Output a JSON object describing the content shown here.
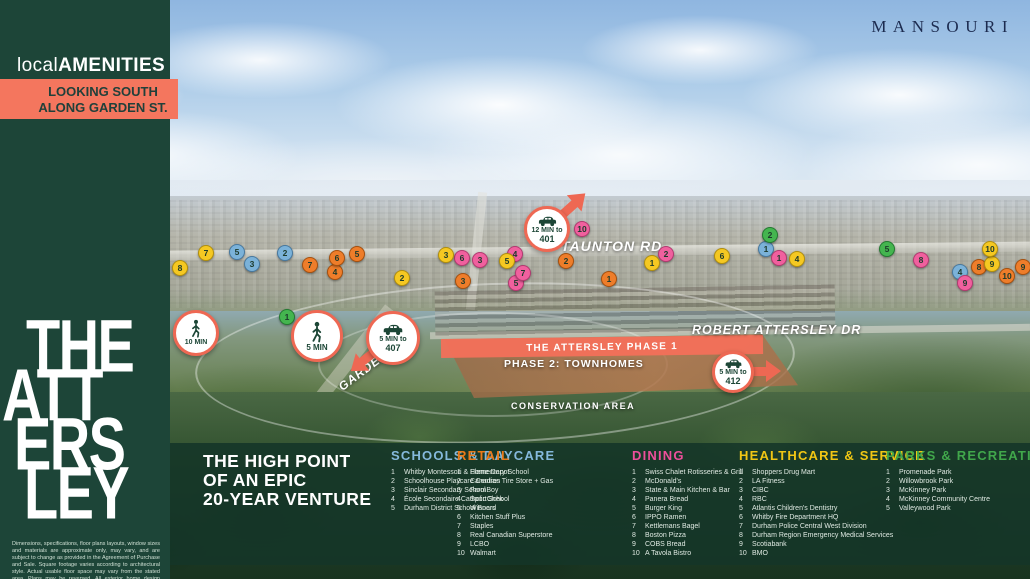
{
  "colors": {
    "sidebar_green": "#1d4538",
    "coral_banner": "#f4765e",
    "badge_coral": "#ee6853",
    "panel_green": "rgba(21,53,40,0.88)",
    "schools": "#85b9dc",
    "retail": "#ea7a19",
    "dining": "#ee4f9b",
    "healthcare": "#f0c614",
    "parks": "#41a74b"
  },
  "header": {
    "developer_logo": "MANSOURI"
  },
  "sidebar": {
    "logo_light": "local",
    "logo_bold": "AMENITIES",
    "view_banner": [
      "LOOKING SOUTH",
      "ALONG GARDEN ST."
    ],
    "project_logo": [
      "THE",
      "ATT",
      "ERS",
      "LEY"
    ],
    "disclaimer": "Dimensions, specifications, floor plans layouts, window sizes and materials are approximate only, may vary, and are subject to change as provided in the Agreement of Purchase and Sale. Square footage varies according to architectural style. Actual usable floor space may vary from the stated area. Plans may be reversed. All exterior home design illustrations are artist's concepts. E.&O.E."
  },
  "map": {
    "road_labels": {
      "taunton": "TAUNTON RD",
      "robert_attersley": "ROBERT ATTERSLEY DR",
      "garden": "GARDEN ST"
    },
    "site_labels": {
      "phase1": "THE ATTERSLEY PHASE 1",
      "phase2": "PHASE 2: TOWNHOMES",
      "conservation": "CONSERVATION AREA"
    },
    "badges": {
      "walk10": {
        "type": "walk",
        "line1": "10 MIN"
      },
      "walk5": {
        "type": "walk",
        "line1": "5 MIN"
      },
      "car407": {
        "type": "car",
        "line1": "5 MIN to",
        "line2": "407"
      },
      "car401": {
        "type": "car",
        "line1": "12 MIN to",
        "line2": "401"
      },
      "car412": {
        "type": "car",
        "line1": "5 MIN to",
        "line2": "412"
      }
    },
    "markers": [
      {
        "category": "schools",
        "label": "1",
        "x": 766,
        "y": 249
      },
      {
        "category": "schools",
        "label": "2",
        "x": 285,
        "y": 253
      },
      {
        "category": "schools",
        "label": "3",
        "x": 252,
        "y": 264
      },
      {
        "category": "schools",
        "label": "4",
        "x": 960,
        "y": 272
      },
      {
        "category": "schools",
        "label": "5",
        "x": 237,
        "y": 252
      },
      {
        "category": "retail",
        "label": "1",
        "x": 609,
        "y": 279
      },
      {
        "category": "retail",
        "label": "2",
        "x": 566,
        "y": 261
      },
      {
        "category": "retail",
        "label": "3",
        "x": 463,
        "y": 281
      },
      {
        "category": "retail",
        "label": "4",
        "x": 335,
        "y": 272
      },
      {
        "category": "retail",
        "label": "5",
        "x": 357,
        "y": 254
      },
      {
        "category": "retail",
        "label": "6",
        "x": 337,
        "y": 258
      },
      {
        "category": "retail",
        "label": "7",
        "x": 310,
        "y": 265
      },
      {
        "category": "retail",
        "label": "8",
        "x": 979,
        "y": 267
      },
      {
        "category": "retail",
        "label": "9",
        "x": 1023,
        "y": 267
      },
      {
        "category": "retail",
        "label": "10",
        "x": 1007,
        "y": 276
      },
      {
        "category": "dining",
        "label": "1",
        "x": 779,
        "y": 258
      },
      {
        "category": "dining",
        "label": "2",
        "x": 666,
        "y": 254
      },
      {
        "category": "dining",
        "label": "3",
        "x": 480,
        "y": 260
      },
      {
        "category": "dining",
        "label": "4",
        "x": 515,
        "y": 254
      },
      {
        "category": "dining",
        "label": "5",
        "x": 516,
        "y": 283
      },
      {
        "category": "dining",
        "label": "6",
        "x": 462,
        "y": 258
      },
      {
        "category": "dining",
        "label": "7",
        "x": 523,
        "y": 273
      },
      {
        "category": "dining",
        "label": "8",
        "x": 921,
        "y": 260
      },
      {
        "category": "dining",
        "label": "9",
        "x": 965,
        "y": 283
      },
      {
        "category": "dining",
        "label": "10",
        "x": 582,
        "y": 229
      },
      {
        "category": "healthcare",
        "label": "1",
        "x": 652,
        "y": 263
      },
      {
        "category": "healthcare",
        "label": "2",
        "x": 402,
        "y": 278
      },
      {
        "category": "healthcare",
        "label": "3",
        "x": 446,
        "y": 255
      },
      {
        "category": "healthcare",
        "label": "4",
        "x": 797,
        "y": 259
      },
      {
        "category": "healthcare",
        "label": "5",
        "x": 507,
        "y": 261
      },
      {
        "category": "healthcare",
        "label": "6",
        "x": 722,
        "y": 256
      },
      {
        "category": "healthcare",
        "label": "7",
        "x": 206,
        "y": 253
      },
      {
        "category": "healthcare",
        "label": "8",
        "x": 180,
        "y": 268
      },
      {
        "category": "healthcare",
        "label": "9",
        "x": 992,
        "y": 264
      },
      {
        "category": "healthcare",
        "label": "10",
        "x": 990,
        "y": 249
      },
      {
        "category": "parks",
        "label": "1",
        "x": 287,
        "y": 317
      },
      {
        "category": "parks",
        "label": "2",
        "x": 770,
        "y": 235
      },
      {
        "category": "parks",
        "label": "5",
        "x": 887,
        "y": 249
      }
    ]
  },
  "legend": {
    "tagline": [
      "THE HIGH POINT",
      "OF AN EPIC",
      "20-YEAR VENTURE"
    ],
    "categories": [
      {
        "id": "schools",
        "label": "SCHOOLS & DAYCARE",
        "color": "#85b9dc",
        "items": [
          "Whitby Montessori & Elementary School",
          "Schoolhouse Playcare Centres",
          "Sinclair Secondary School",
          "École Secondaire Catholic School",
          "Durham District School Board"
        ]
      },
      {
        "id": "retail",
        "label": "RETAIL",
        "color": "#ea7a19",
        "items": [
          "Home Depot",
          "Canadian Tire Store + Gas",
          "FarmBoy",
          "SportChek",
          "Winners",
          "Kitchen Stuff Plus",
          "Staples",
          "Real Canadian Superstore",
          "LCBO",
          "Walmart"
        ]
      },
      {
        "id": "dining",
        "label": "DINING",
        "color": "#ee4f9b",
        "items": [
          "Swiss Chalet Rotisseries & Grill",
          "McDonald's",
          "State & Main Kitchen & Bar",
          "Panera Bread",
          "Burger King",
          "IPPO Ramen",
          "Kettlemans Bagel",
          "Boston Pizza",
          "COBS Bread",
          "A Tavola Bistro"
        ]
      },
      {
        "id": "healthcare",
        "label": "HEALTHCARE & SERVICE",
        "color": "#f0c614",
        "items": [
          "Shoppers Drug Mart",
          "LA Fitness",
          "CIBC",
          "RBC",
          "Atlantis Children's Dentistry",
          "Whitby Fire Department HQ",
          "Durham Police Central West Division",
          "Durham Region Emergency Medical Services",
          "Scotiabank",
          "BMO"
        ]
      },
      {
        "id": "parks",
        "label": "PARKS & RECREATION",
        "color": "#41a74b",
        "items": [
          "Promenade Park",
          "Willowbrook Park",
          "McKinney Park",
          "McKinney Community Centre",
          "Valleywood Park"
        ]
      }
    ]
  }
}
